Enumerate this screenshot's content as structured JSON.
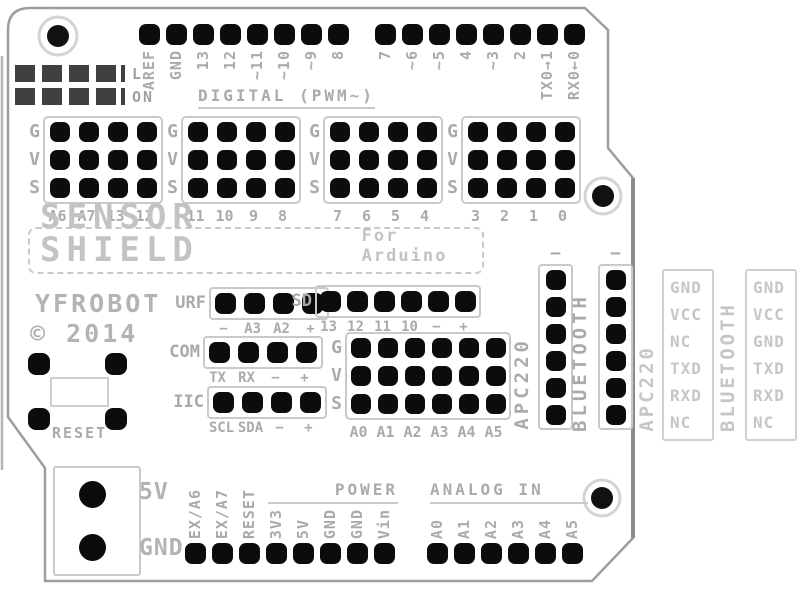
{
  "colors": {
    "pin_black": "#0c0c0c",
    "silkscreen_gray": "#aaaaaa",
    "silkscreen_light_gray": "#c6c6c6",
    "board_outline_gray": "#9e9e9e",
    "led_pad_dark": "#404040",
    "background": "#ffffff"
  },
  "board": {
    "title": "SENSOR SHIELD",
    "subtitle": "For Arduino",
    "brand": "YFROBOT",
    "copyright": "© 2014",
    "reset_label": "RESET",
    "digital_heading": "DIGITAL (PWM~)",
    "power_heading": "POWER",
    "analog_heading": "ANALOG IN",
    "led_labels": [
      "L",
      "ON"
    ]
  },
  "top_header": {
    "left_pins": [
      "AREF",
      "GND",
      "13",
      "12",
      "~11",
      "~10",
      "~9",
      "8"
    ],
    "right_pins": [
      "7",
      "~6",
      "~5",
      "4",
      "~3",
      "2",
      "TX0→1",
      "RX0←0"
    ]
  },
  "gvs": {
    "row_labels": [
      "G",
      "V",
      "S"
    ],
    "blocks": [
      {
        "columns": [
          "A6",
          "A7",
          "13",
          "12"
        ]
      },
      {
        "columns": [
          "11",
          "10",
          "9",
          "8"
        ]
      },
      {
        "columns": [
          "7",
          "6",
          "5",
          "4"
        ]
      },
      {
        "columns": [
          "3",
          "2",
          "1",
          "0"
        ]
      }
    ]
  },
  "middle": {
    "urf": {
      "label": "URF",
      "pin_labels": [
        "−",
        "A3",
        "A2",
        "+"
      ]
    },
    "sd": {
      "label": "SD",
      "pin_labels": [
        "13",
        "12",
        "11",
        "10",
        "−",
        "+"
      ]
    },
    "com": {
      "label": "COM",
      "pin_labels": [
        "TX",
        "RX",
        "−",
        "+"
      ]
    },
    "iic": {
      "label": "IIC",
      "pin_labels": [
        "SCL",
        "SDA",
        "−",
        "+"
      ]
    },
    "analog": {
      "row_labels": [
        "G",
        "V",
        "S"
      ],
      "columns": [
        "A0",
        "A1",
        "A2",
        "A3",
        "A4",
        "A5"
      ]
    }
  },
  "wireless": {
    "onboard": [
      {
        "name": "APC220",
        "minus": "−"
      },
      {
        "name": "BLUETOOTH",
        "minus": "−"
      }
    ],
    "pinouts": [
      {
        "name": "APC220",
        "pins": [
          "GND",
          "VCC",
          "NC",
          "TXD",
          "RXD",
          "NC"
        ]
      },
      {
        "name": "BLUETOOTH",
        "pins": [
          "GND",
          "VCC",
          "GND",
          "TXD",
          "RXD",
          "NC"
        ]
      }
    ]
  },
  "bottom": {
    "power_block": {
      "top": "5V",
      "bottom": "GND"
    },
    "power_pins": [
      "EX/A6",
      "EX/A7",
      "RESET",
      "3V3",
      "5V",
      "GND",
      "GND",
      "Vin"
    ],
    "analog_pins": [
      "A0",
      "A1",
      "A2",
      "A3",
      "A4",
      "A5"
    ]
  }
}
